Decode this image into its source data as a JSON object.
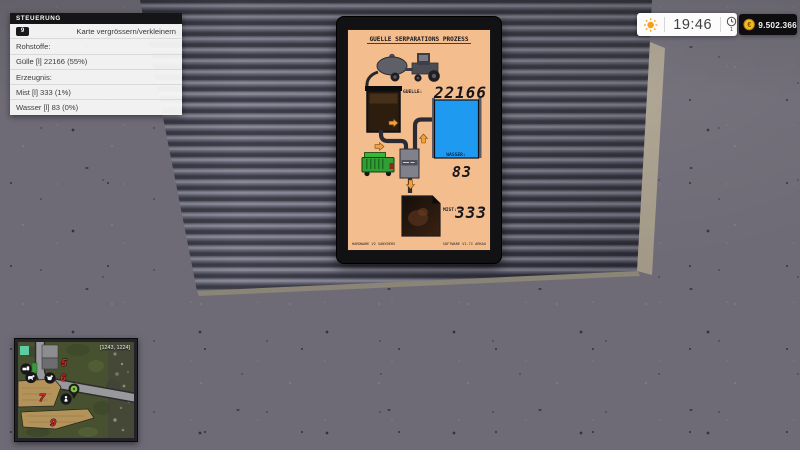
{
  "hud": {
    "control_panel": {
      "title": "STEUERUNG",
      "key_hint": {
        "key": "9",
        "label": "Karte vergrössern/verkleinern"
      },
      "rows": [
        "Rohstoffe:",
        "Gülle [l] 22166 (55%)",
        "Erzeugnis:",
        "Mist [l] 333 (1%)",
        "Wasser [l] 83 (0%)"
      ]
    },
    "clock": {
      "time": "19:46",
      "timescale": "1"
    },
    "money": {
      "amount": "9.502.366",
      "currency_symbol": "€"
    },
    "minimap": {
      "coordinates": "[1243, 1224]",
      "field_numbers": [
        "5",
        "6",
        "7",
        "9"
      ]
    }
  },
  "display_panel": {
    "title": "GUELLE SERPARATIONS PROZESS",
    "guelle": {
      "label": "GUELLE:",
      "value": "22166"
    },
    "wasser": {
      "label": "WASSER:",
      "value": "83"
    },
    "mist": {
      "label": "MIST:",
      "value": "333"
    },
    "footer_left": "HARDWARE V2 SANYDERS",
    "footer_right": "SOFTWARE V1.7I ARKAU"
  },
  "colors": {
    "screen_bg": "#f4bd8e",
    "water_blue": "#1e9bf0",
    "field_number_red": "#ce2b2c",
    "money_gold": "#f5b81e",
    "sun_orange": "#f59f1e"
  }
}
